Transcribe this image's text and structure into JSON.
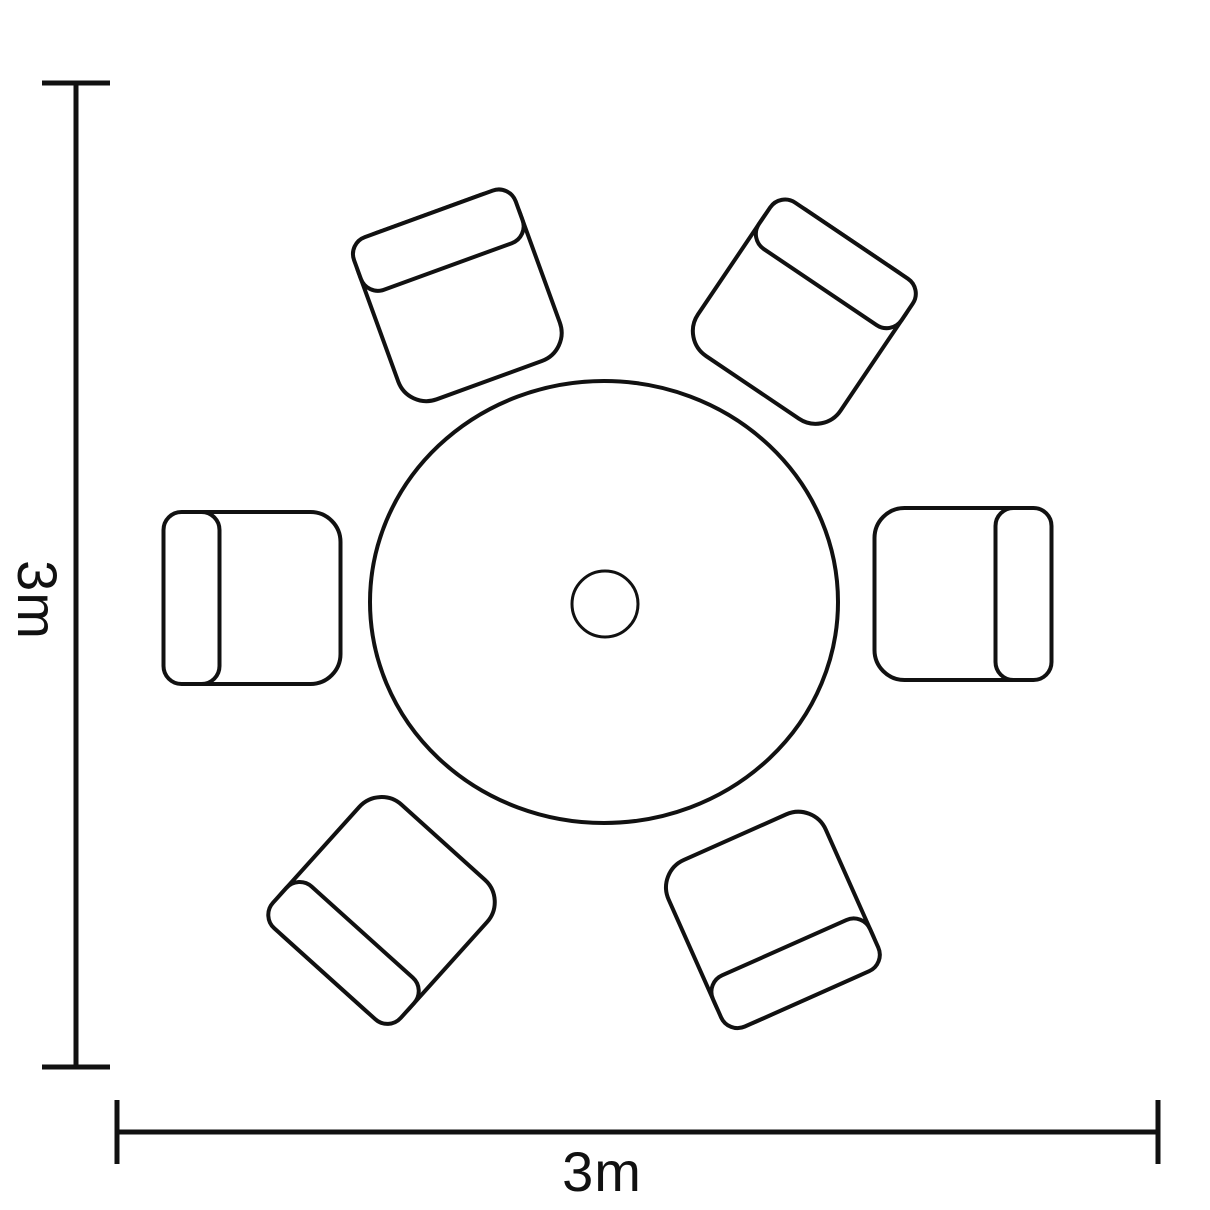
{
  "figure": {
    "kind": "furniture-layout-top-view",
    "background_color": "#ffffff",
    "line_color": "#111111",
    "table": {
      "shape": "round",
      "feature": "parasol-hole-center"
    },
    "chairs": {
      "count": 6,
      "shape": "square-with-backrest"
    },
    "dimensions": {
      "height_label": "3m",
      "width_label": "3m"
    }
  }
}
